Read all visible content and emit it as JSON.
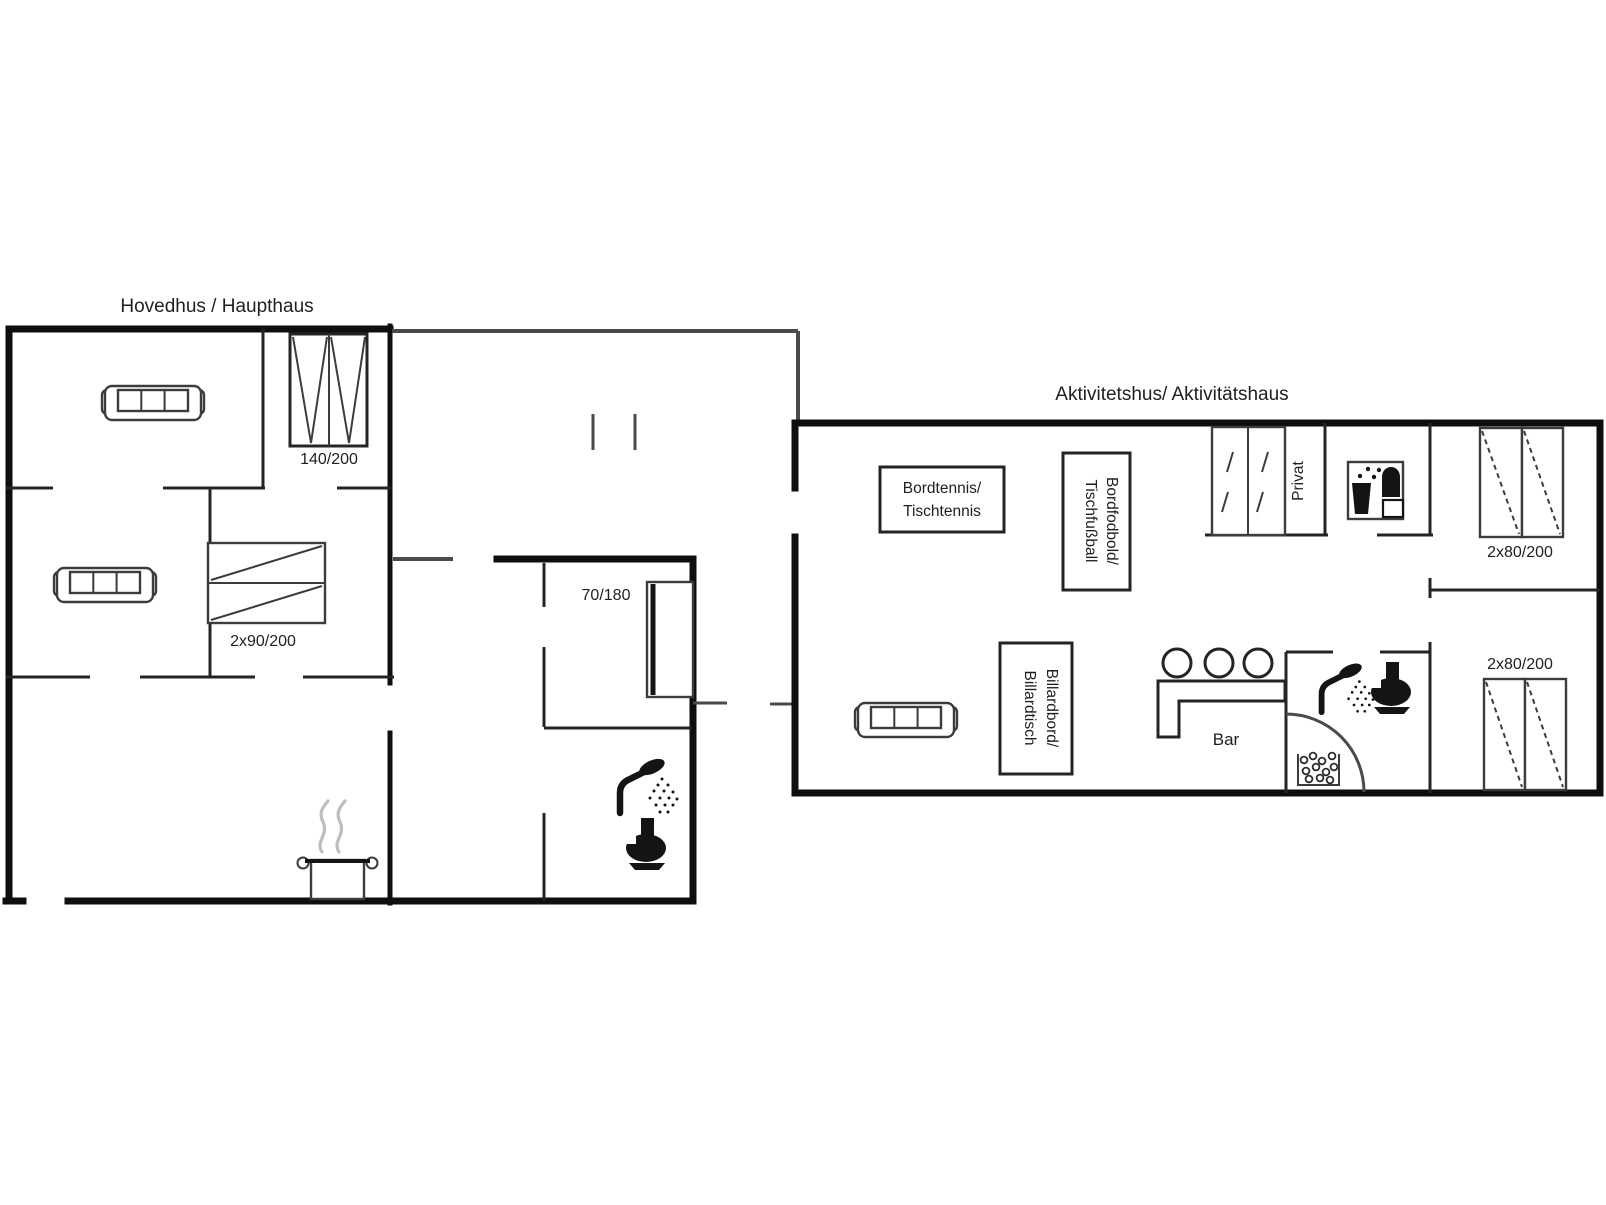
{
  "colors": {
    "background": "#ffffff",
    "wall": "#0e0e0e",
    "interior_wall": "#242424",
    "furniture": "#3c3c3c",
    "label": "#1f1f1f",
    "steam": "#bdbdbd"
  },
  "main_house": {
    "title": "Hovedhus / Haupthaus",
    "wardrobe_label": "140/200",
    "bunk_label": "2x90/200",
    "bed_label": "70/180"
  },
  "activity_house": {
    "title": "Aktivitetshus/ Aktivitätshaus",
    "table_tennis": {
      "line1": "Bordtennis/",
      "line2": "Tischtennis"
    },
    "foosball": {
      "line1": "Bordfodbold/",
      "line2": "Tischfußball"
    },
    "billiard": {
      "line1": "Billardbord/",
      "line2": "Billardtisch"
    },
    "privat_label": "Privat",
    "bar_label": "Bar",
    "bed_label_top": "2x80/200",
    "bed_label_bottom": "2x80/200"
  },
  "icons": {
    "stove": "pot-with-steam",
    "shower": "shower-head-with-spray",
    "toilet": "toilet-silhouette",
    "whirlpool": "basin-with-bubbles",
    "washing_machine": "washer-with-bubbles",
    "wardrobe": "double-door-wardrobe",
    "bar_stool": "circle-stool"
  }
}
